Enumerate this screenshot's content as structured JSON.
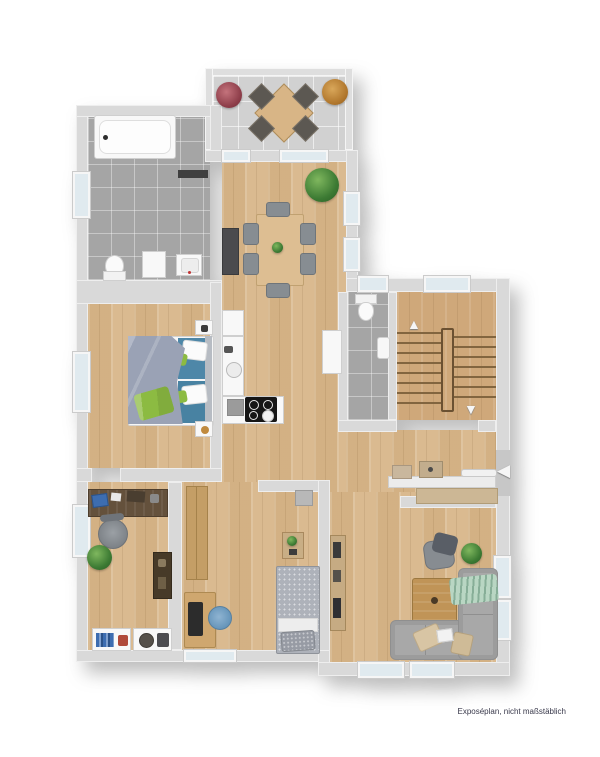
{
  "page": {
    "background": "#ffffff",
    "footer_note": "Exposéplan, nicht maßstäblich"
  },
  "palette": {
    "wall": "#d9d9d9",
    "wood_floor": "#d8b689",
    "stair_wood": "#cfa87a",
    "bath_tile": "#a5a5a5",
    "terrace_tile": "#d1d1d1",
    "window_glass": "#e0eaef",
    "sofa_gray": "#a8a8a8",
    "bed_blue": "#4e87a8",
    "accent_green": "#8cbb42",
    "mint_throw": "#b9d6c3",
    "counter_white": "#f8f8f8",
    "cooktop_black": "#161616"
  },
  "icons": {
    "stairs_up": "▲",
    "stairs_down": "▼",
    "entry_arrow": "◀"
  }
}
